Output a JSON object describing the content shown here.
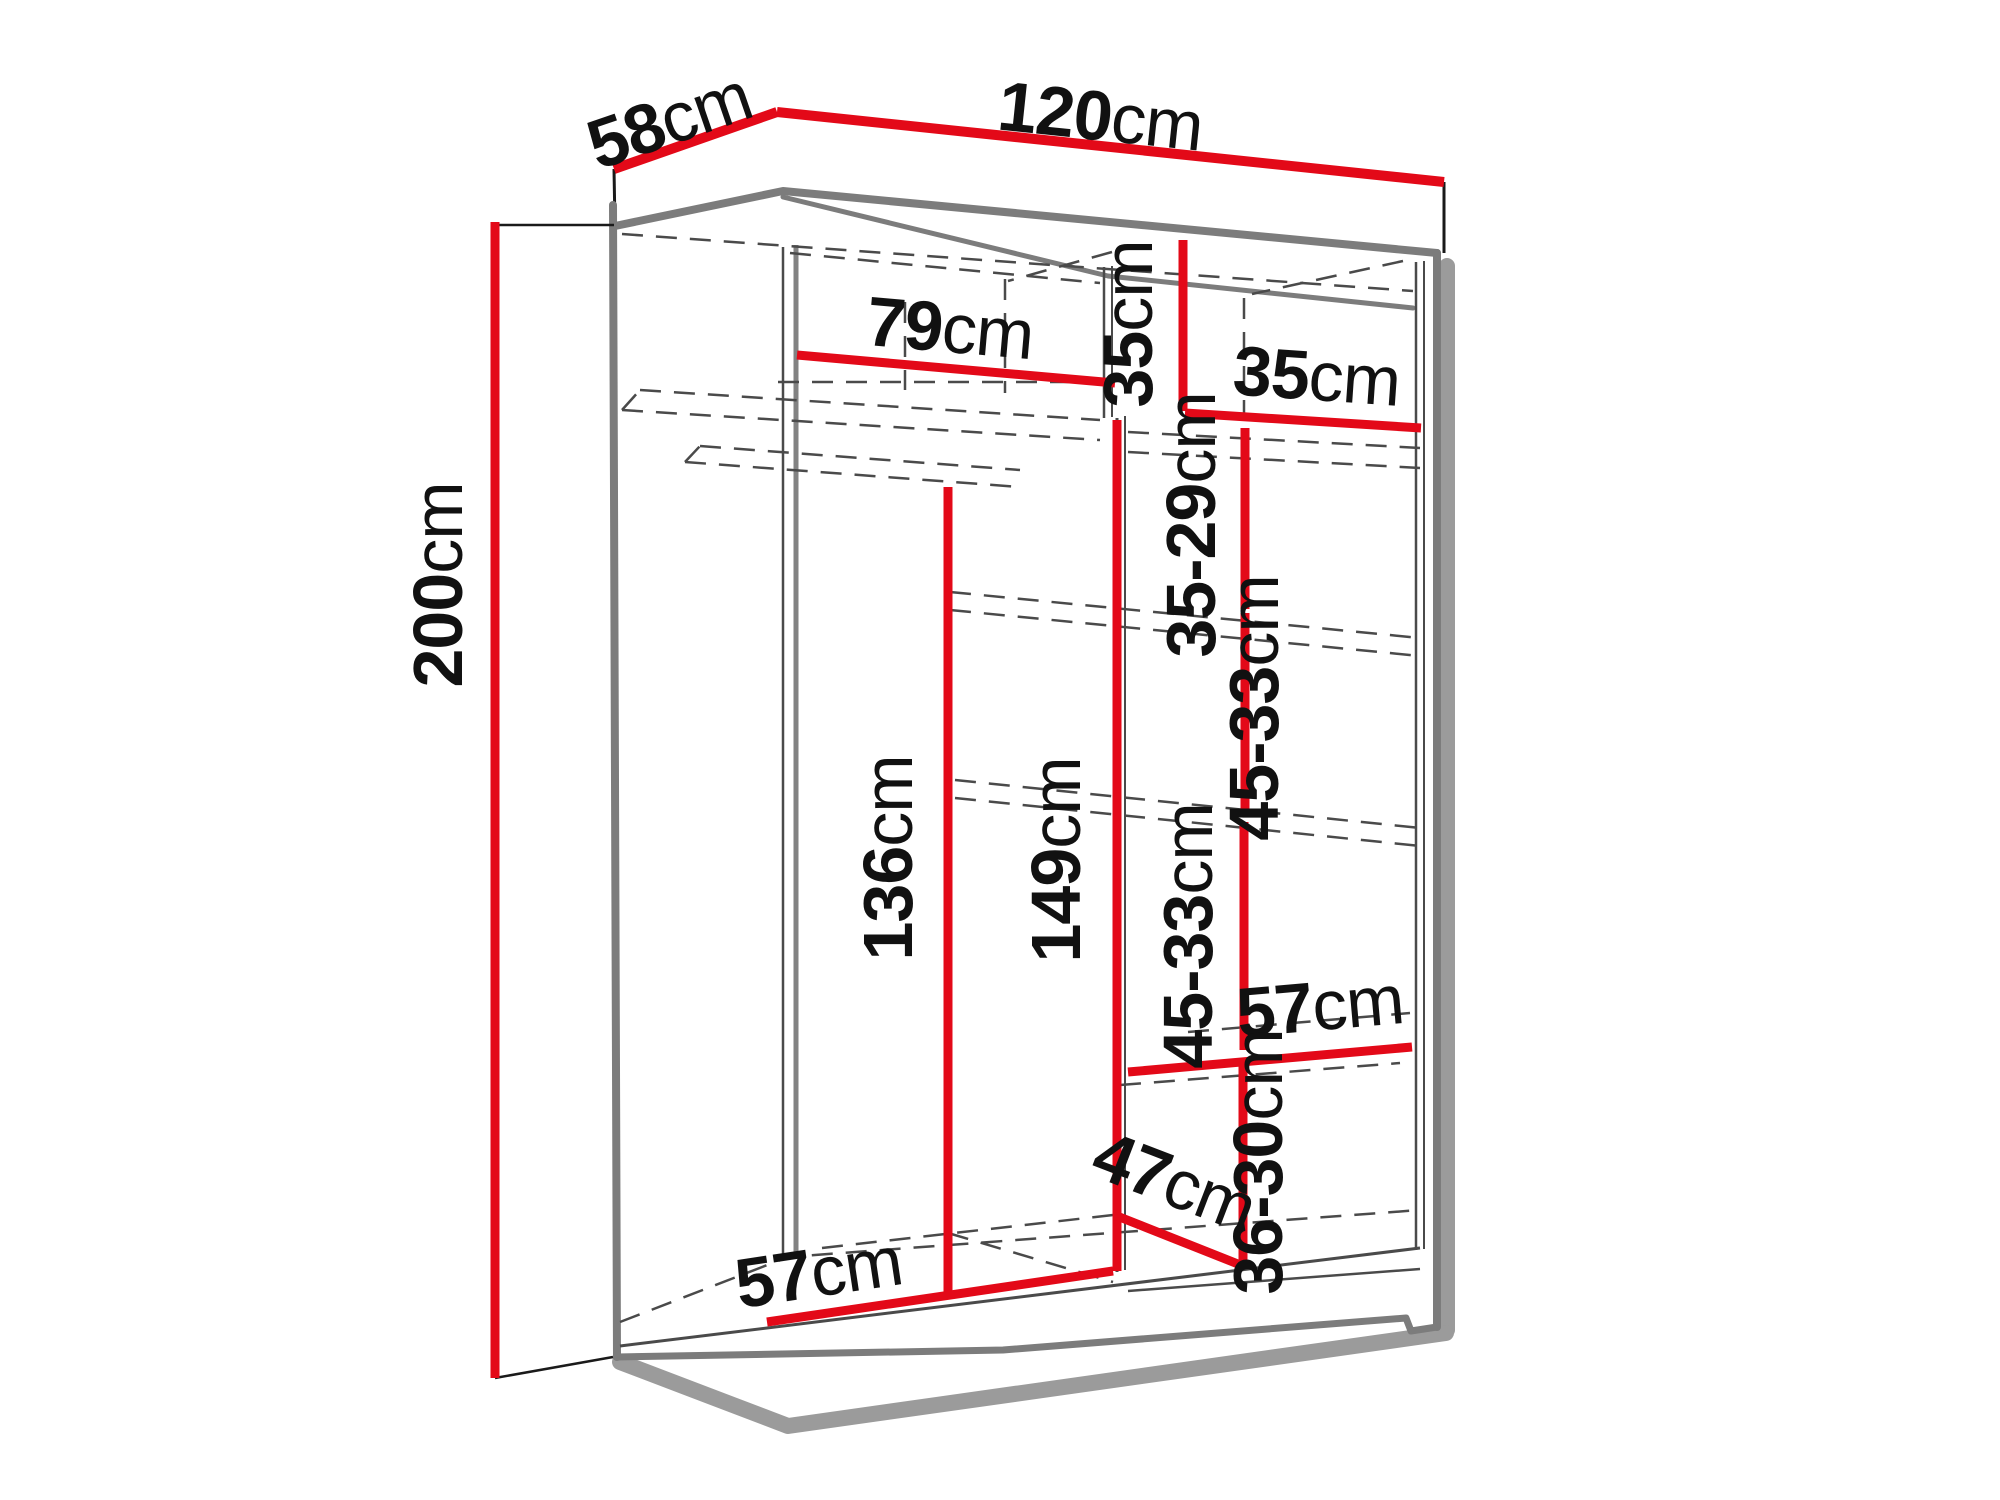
{
  "diagram": {
    "subject": "wardrobe-interior-dimension-diagram",
    "unit": "cm",
    "colors": {
      "dimension_red": "#e30918",
      "carcass_gray": "#7c7c7c",
      "hidden_line_gray": "#4a4a4a",
      "shadow_gray": "#9b9b9b",
      "label_text": "#111111",
      "background": "#ffffff"
    },
    "labels": {
      "depth_top": {
        "num": "58",
        "unit": "cm"
      },
      "width_top": {
        "num": "120",
        "unit": "cm"
      },
      "height_left": {
        "num": "200",
        "unit": "cm"
      },
      "inner_width_left": {
        "num": "79",
        "unit": "cm"
      },
      "right_col_top_height": {
        "num": "35",
        "unit": "cm"
      },
      "right_col_top_width": {
        "num": "35",
        "unit": "cm"
      },
      "right_gap_1": {
        "num": "35-29",
        "unit": "cm"
      },
      "right_gap_2": {
        "num": "45-33",
        "unit": "cm"
      },
      "right_gap_3": {
        "num": "45-33",
        "unit": "cm"
      },
      "left_hanging_height": {
        "num": "136",
        "unit": "cm"
      },
      "mid_height": {
        "num": "149",
        "unit": "cm"
      },
      "right_bottom_depth": {
        "num": "57",
        "unit": "cm"
      },
      "right_bottom_height": {
        "num": "36-30",
        "unit": "cm"
      },
      "bottom_diagonal": {
        "num": "47",
        "unit": "cm"
      },
      "left_bottom_depth": {
        "num": "57",
        "unit": "cm"
      }
    }
  }
}
